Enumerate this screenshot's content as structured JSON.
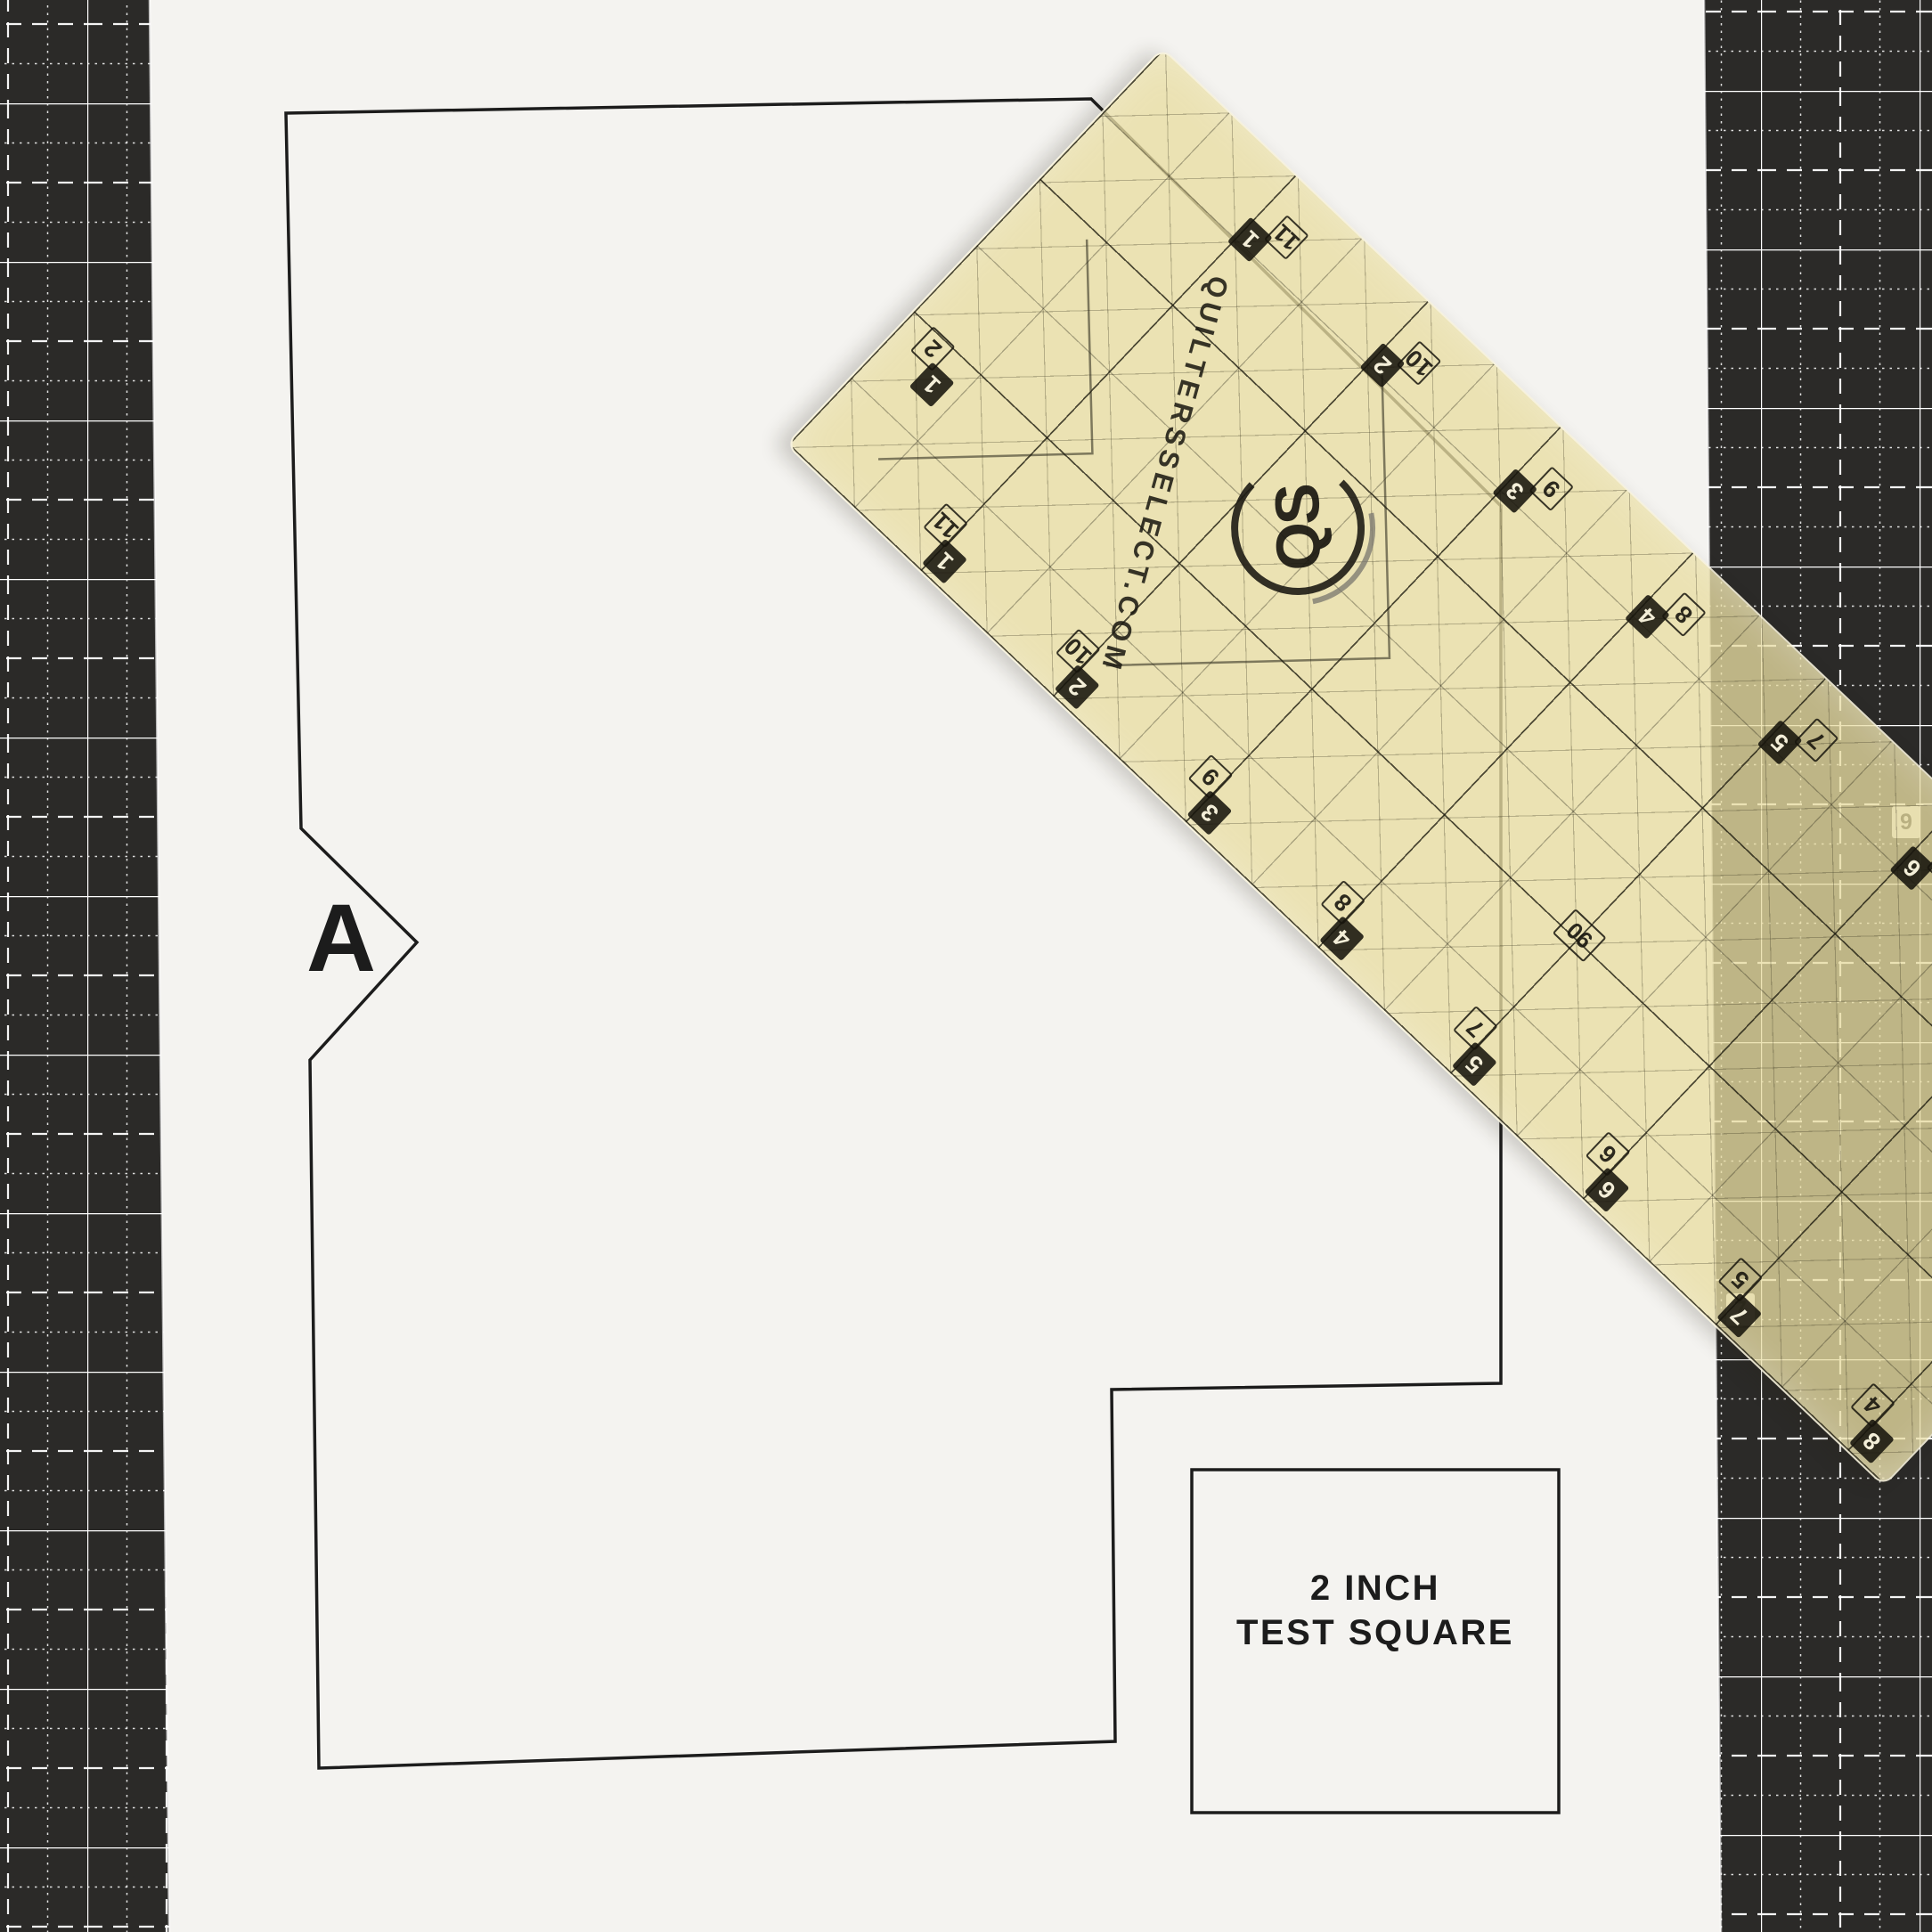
{
  "scene": {
    "description": "Paper quilting pattern piece on a black cutting mat with a translucent Quilters Select ruler laid diagonally across the top right corner"
  },
  "pattern": {
    "piece_label": "A"
  },
  "test_square": {
    "line1": "2 INCH",
    "line2": "TEST SQUARE"
  },
  "ruler": {
    "brand_text": "QUILTERSSELECT.COM",
    "logo_text": "QS",
    "angle_label": "90",
    "edge_pairs": [
      {
        "filled": "1",
        "outline": "11"
      },
      {
        "filled": "2",
        "outline": "10"
      },
      {
        "filled": "3",
        "outline": "9"
      },
      {
        "filled": "4",
        "outline": "8"
      },
      {
        "filled": "5",
        "outline": "7"
      },
      {
        "filled": "6",
        "outline": "6"
      },
      {
        "filled": "7",
        "outline": "5"
      },
      {
        "filled": "8",
        "outline": "4"
      },
      {
        "filled": "9",
        "outline": "3"
      }
    ],
    "cross_pair": {
      "filled": "1",
      "outline": "2"
    }
  },
  "mat": {
    "corner_labels": [
      {
        "text": "9"
      },
      {
        "text": "7"
      }
    ]
  },
  "colors": {
    "mat": "#2b2a28",
    "mat_line": "#ffffff",
    "paper": "#f4f3f0",
    "ruler_tint": "rgba(232,221,162,0.78)",
    "ink": "#1c1c1c"
  }
}
